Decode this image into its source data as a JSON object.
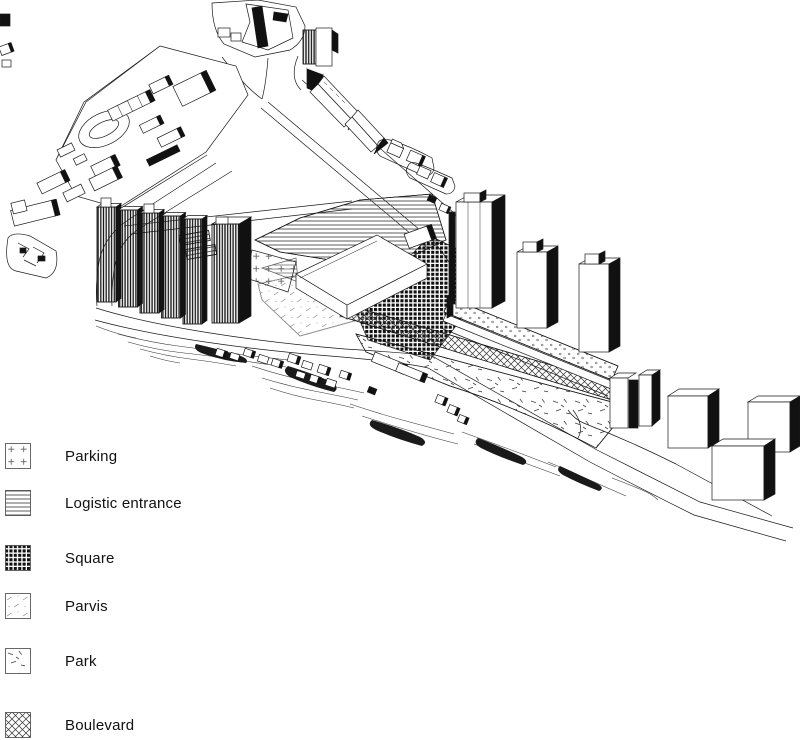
{
  "figure": {
    "kind": "axonometric-site-plan",
    "ink_color": "#1a1a1a",
    "paper_color": "#ffffff"
  },
  "legend": {
    "items": [
      {
        "label": "Parking",
        "pattern": "parking"
      },
      {
        "label": "Logistic entrance",
        "pattern": "hlines"
      },
      {
        "label": "Square",
        "pattern": "grid"
      },
      {
        "label": "Parvis",
        "pattern": "parvis"
      },
      {
        "label": "Park",
        "pattern": "park"
      },
      {
        "label": "Boulevard",
        "pattern": "cross"
      }
    ]
  }
}
